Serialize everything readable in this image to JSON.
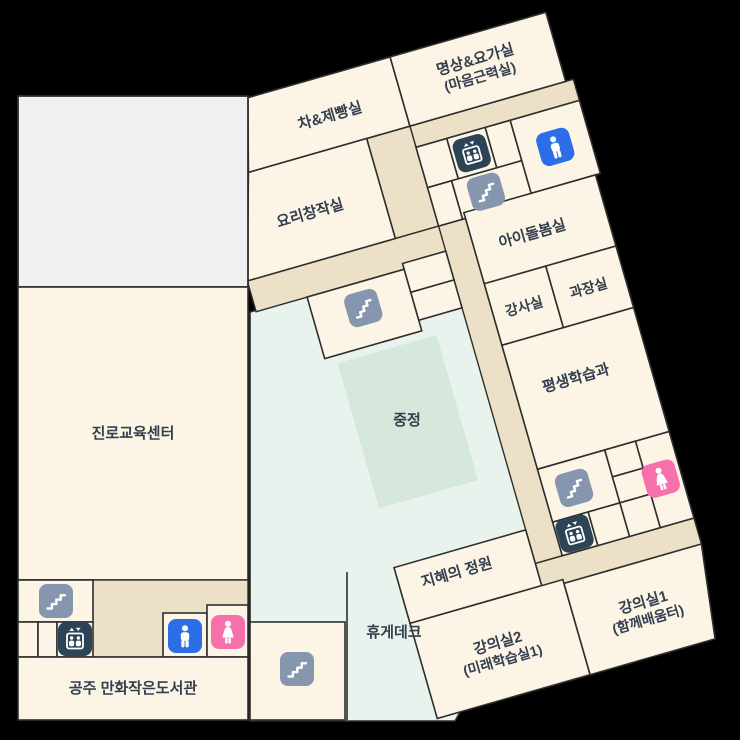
{
  "map": {
    "title": "floor-plan",
    "background_color": "#000000",
    "colors": {
      "room_fill": "#fcf5e6",
      "corridor_fill": "#ece0c6",
      "courtyard_fill": "#e9f3ee",
      "courtyard_inner_fill": "#d6e8dc",
      "gray_block_fill": "#f0f0f0",
      "wall": "#2e2e2e",
      "label_text": "#333f4e",
      "stairs_icon_bg": "#8696ae",
      "elevator_icon_bg": "#2d4356",
      "mens_toilet_icon_bg": "#2c6ee8",
      "womens_toilet_icon_bg": "#f76fab"
    },
    "rooms": {
      "tea_baking": "차&제빵실",
      "meditation_yoga_line1": "명상&요가실",
      "meditation_yoga_line2": "(마음근력실)",
      "cooking_studio": "요리창작실",
      "childcare": "아이돌봄실",
      "instructor": "강사실",
      "manager": "과장실",
      "lifelong_learning": "평생학습과",
      "career_center": "진로교육센터",
      "courtyard": "중정",
      "wisdom_garden": "지혜의 정원",
      "rest_deck": "휴게데크",
      "lecture2_line1": "강의실2",
      "lecture2_line2": "(미래학습실1)",
      "lecture1_line1": "강의실1",
      "lecture1_line2": "(함께배움터)",
      "comic_library": "공주 만화작은도서관"
    },
    "icons": {
      "stairs": "stairs-icon",
      "elevator": "elevator-icon",
      "mens_toilet": "mens-toilet-icon",
      "womens_toilet": "womens-toilet-icon"
    }
  }
}
